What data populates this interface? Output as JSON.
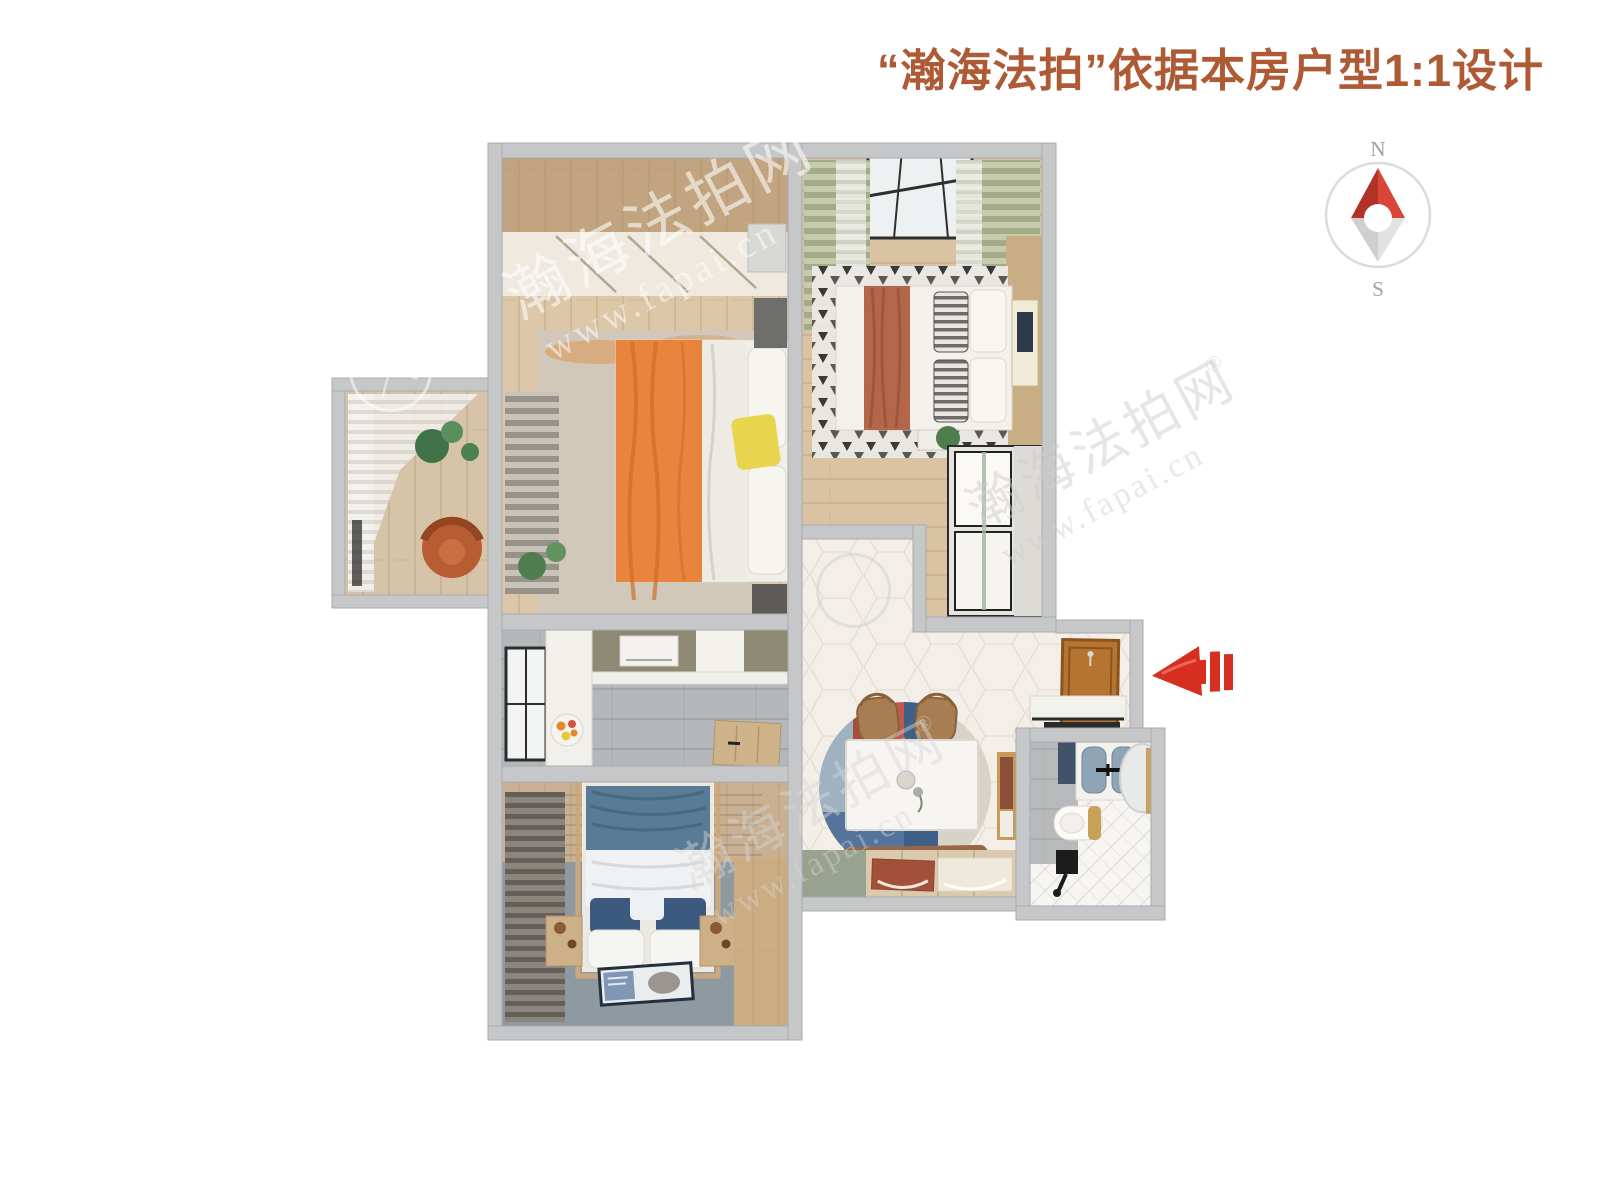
{
  "header": {
    "title": "“瀚海法拍”依据本房户型1:1设计",
    "title_color": "#ad5a35"
  },
  "compass": {
    "north": "N",
    "south": "S",
    "colors": {
      "ring": "#dcdcdc",
      "labels": "#a0a0a0",
      "needle_north_dark": "#b33228",
      "needle_north_light": "#d84638",
      "needle_south_dark": "#cfcfcf",
      "needle_south_light": "#e2e2e2"
    }
  },
  "entrance": {
    "direction": "left",
    "arrow_color": "#d62e1f"
  },
  "watermark": {
    "brand": "瀚海法拍网",
    "registered_mark": "®",
    "url": "www.fapai.cn"
  },
  "rooms": [
    "master-bedroom",
    "second-bedroom",
    "kitchen",
    "third-bedroom",
    "dining-hall",
    "entry",
    "bathroom",
    "balcony"
  ],
  "palette": {
    "wall": "#c6c7c9",
    "wood_floor": "#dcc7a8",
    "hall_tile": "#f3efe8",
    "kitchen_tile": "#b5b8ba",
    "bedroom3_floor": "#8e99a2",
    "bath_tile": "#f6f5f1",
    "accent_orange": "#e8843c",
    "accent_rust": "#b4664a",
    "accent_blue": "#3e5f88",
    "accent_yellow": "#e9d44e",
    "curtain_green": "#a9b18e",
    "door_wood": "#b5742f"
  }
}
